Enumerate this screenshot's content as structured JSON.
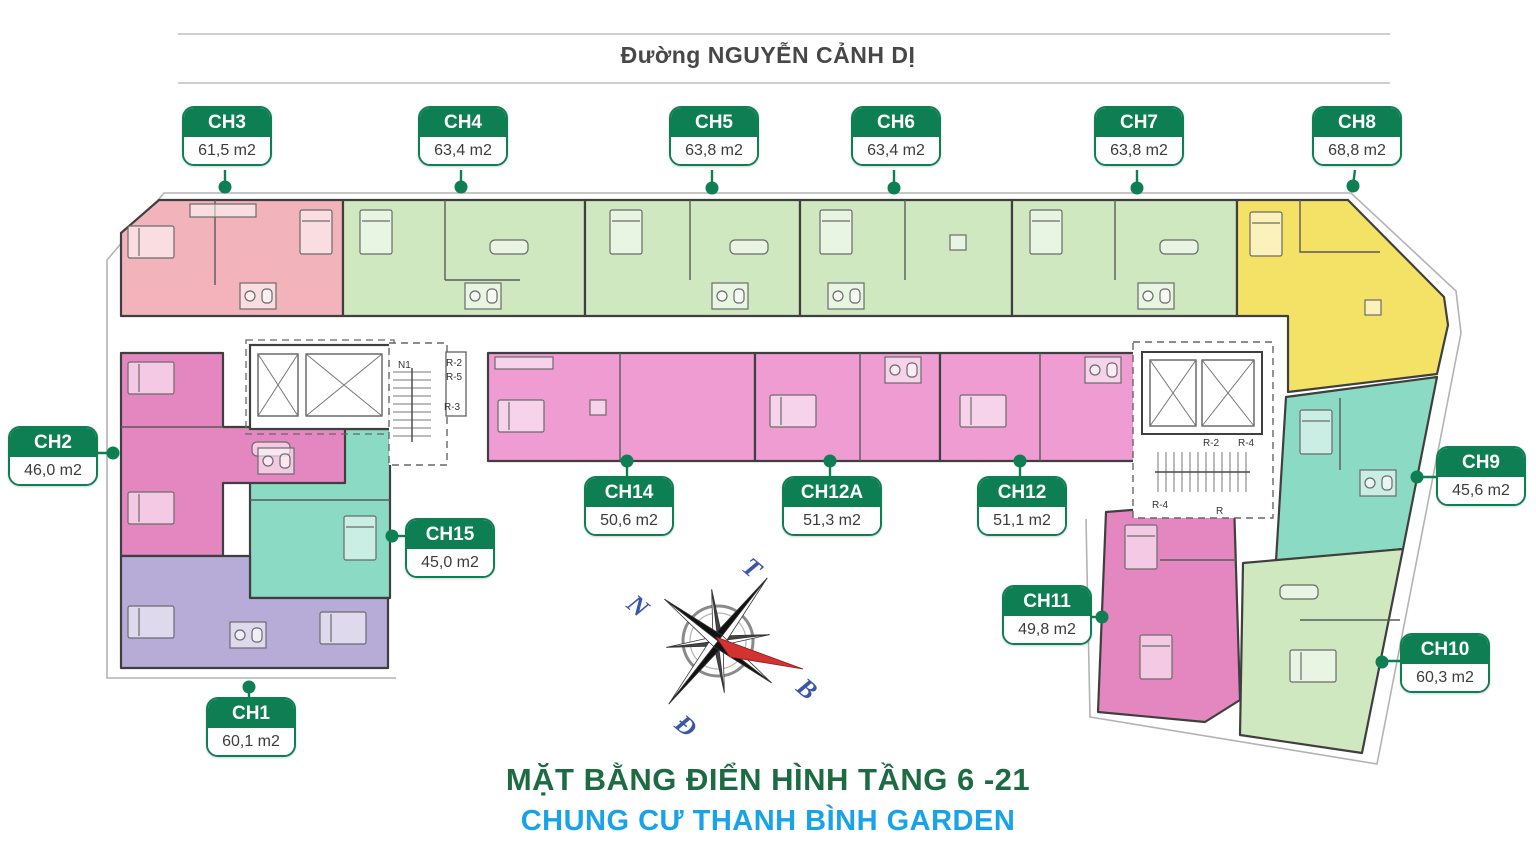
{
  "street": {
    "name": "Đường NGUYỄN CẢNH DỊ"
  },
  "titles": {
    "main": "MẶT BẰNG ĐIỂN HÌNH TẦNG 6 -21",
    "subtitle": "CHUNG CƯ THANH BÌNH GARDEN"
  },
  "units": [
    {
      "id": "CH3",
      "area": "61,5 m2",
      "color": "#f2b4ba"
    },
    {
      "id": "CH4",
      "area": "63,4 m2",
      "color": "#cfe8c0"
    },
    {
      "id": "CH5",
      "area": "63,8 m2",
      "color": "#cfe8c0"
    },
    {
      "id": "CH6",
      "area": "63,4 m2",
      "color": "#cfe8c0"
    },
    {
      "id": "CH7",
      "area": "63,8 m2",
      "color": "#cfe8c0"
    },
    {
      "id": "CH8",
      "area": "68,8 m2",
      "color": "#f4e267"
    },
    {
      "id": "CH2",
      "area": "46,0 m2",
      "color": "#e487c0"
    },
    {
      "id": "CH9",
      "area": "45,6 m2",
      "color": "#8adac4"
    },
    {
      "id": "CH15",
      "area": "45,0 m2",
      "color": "#8adac4"
    },
    {
      "id": "CH14",
      "area": "50,6 m2",
      "color": "#ee9cd2"
    },
    {
      "id": "CH12A",
      "area": "51,3 m2",
      "color": "#ee9cd2"
    },
    {
      "id": "CH12",
      "area": "51,1 m2",
      "color": "#ee9cd2"
    },
    {
      "id": "CH11",
      "area": "49,8 m2",
      "color": "#e487c0"
    },
    {
      "id": "CH10",
      "area": "60,3 m2",
      "color": "#cfe8c0"
    },
    {
      "id": "CH1",
      "area": "60,1 m2",
      "color": "#b7abd8"
    }
  ],
  "cores": {
    "left": {
      "stair_name": "N1",
      "rooms": [
        "R-2",
        "R-5",
        "R-3"
      ]
    },
    "right": {
      "rooms": [
        "R-2",
        "R-4",
        "R-4",
        "R"
      ]
    }
  },
  "compass": {
    "letters": {
      "top": "T",
      "left": "N",
      "right": "B",
      "bottom": "Đ"
    }
  },
  "palette": {
    "label_green": "#0e7f53",
    "wall": "#3f3f3f",
    "title_green": "#1d6b43",
    "title_blue": "#18a2e8",
    "street_text": "#474747",
    "compass_blue": "#3b55a8",
    "compass_red": "#d23230"
  }
}
